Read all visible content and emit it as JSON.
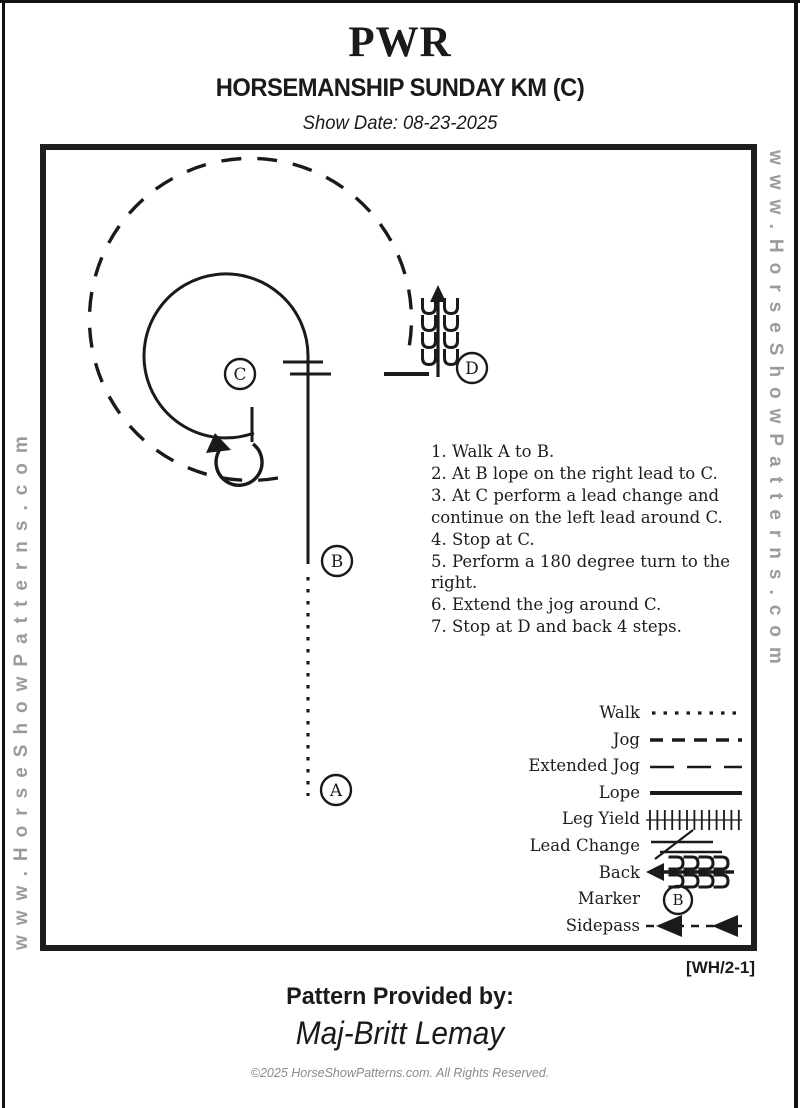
{
  "header": {
    "title": "PWR",
    "subtitle": "HORSEMANSHIP SUNDAY KM (C)",
    "show_date": "Show Date: 08-23-2025"
  },
  "watermark": {
    "text": "www.HorseShowPatterns.com"
  },
  "pattern": {
    "markers": {
      "a": "A",
      "b": "B",
      "c": "C",
      "d": "D"
    },
    "gaits_shown": [
      "walk",
      "lope",
      "extended jog",
      "back",
      "lead change",
      "180 turn"
    ]
  },
  "instructions": {
    "lines": [
      "1. Walk A to B.",
      "2. At B lope on the right lead to C.",
      "3. At C perform a lead change and",
      "continue on the left lead around C.",
      "4. Stop at C.",
      "5. Perform a 180 degree turn to the",
      "right.",
      "6. Extend the jog around C.",
      "7. Stop at D and back 4 steps."
    ]
  },
  "legend": {
    "rows": [
      {
        "label": "Walk"
      },
      {
        "label": "Jog"
      },
      {
        "label": "Extended Jog"
      },
      {
        "label": "Lope"
      },
      {
        "label": "Leg Yield"
      },
      {
        "label": "Lead Change"
      },
      {
        "label": "Back"
      },
      {
        "label": "Marker"
      },
      {
        "label": "Sidepass"
      }
    ],
    "marker_letter": "B"
  },
  "footer": {
    "sheet_code": "[WH/2-1]",
    "provided_by_label": "Pattern Provided by:",
    "provider": "Maj-Britt Lemay",
    "copyright": "©2025 HorseShowPatterns.com. All Rights Reserved."
  },
  "colors": {
    "ink": "#1a1a1a",
    "watermark_gray": "#9b9b9b",
    "copyright_gray": "#8a8a8a"
  }
}
